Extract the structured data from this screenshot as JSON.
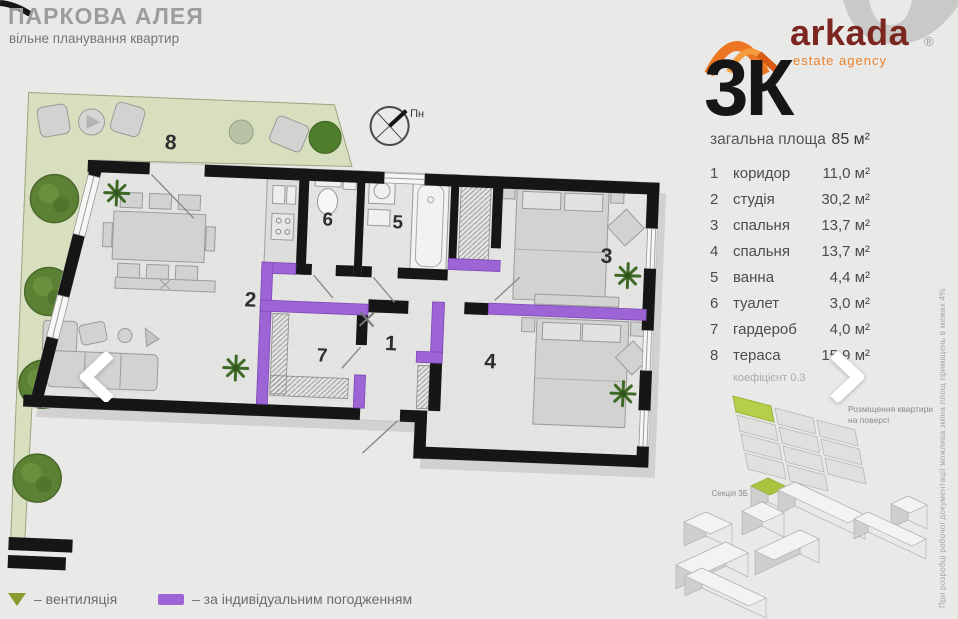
{
  "header": {
    "title": "ПАРКОВА АЛЕЯ",
    "subtitle": "вільне планування квартир"
  },
  "logo": {
    "brand": "arkada",
    "tagline": "estate agency",
    "registered": "®"
  },
  "panel": {
    "type": "3К",
    "total_label": "загальна площа",
    "total_value": "85 м²",
    "rooms": [
      {
        "num": "1",
        "name": "коридор",
        "area": "11,0 м²"
      },
      {
        "num": "2",
        "name": "студія",
        "area": "30,2 м²"
      },
      {
        "num": "3",
        "name": "спальня",
        "area": "13,7 м²"
      },
      {
        "num": "4",
        "name": "спальня",
        "area": "13,7 м²"
      },
      {
        "num": "5",
        "name": "ванна",
        "area": "4,4 м²"
      },
      {
        "num": "6",
        "name": "туалет",
        "area": "3,0 м²"
      },
      {
        "num": "7",
        "name": "гардероб",
        "area": "4,0 м²"
      },
      {
        "num": "8",
        "name": "тераса",
        "area": "15,9 м²"
      }
    ],
    "coefficient": "коефіцієнт 0.3",
    "position_caption": "Розміщення квартири на поверсі",
    "section_caption": "Секція 3Б"
  },
  "plan": {
    "compass": "Пн",
    "numbers": {
      "n1": "1",
      "n2": "2",
      "n3": "3",
      "n4": "4",
      "n5": "5",
      "n6": "6",
      "n7": "7",
      "n8": "8"
    }
  },
  "legend": {
    "ventilation": "– вентиляція",
    "individual": "– за індивідуальним погодженням"
  },
  "disclaimer": "При розробці робочої документації можлива зміна площ приміщень в межах 4%",
  "colors": {
    "purple": "#9d64d6",
    "terrace_green": "#d8dfbe",
    "vent_olive": "#8a9a2c",
    "brand_orange": "#ed7622",
    "brand_maroon": "#7c2621",
    "section_green": "#a9c43e"
  }
}
